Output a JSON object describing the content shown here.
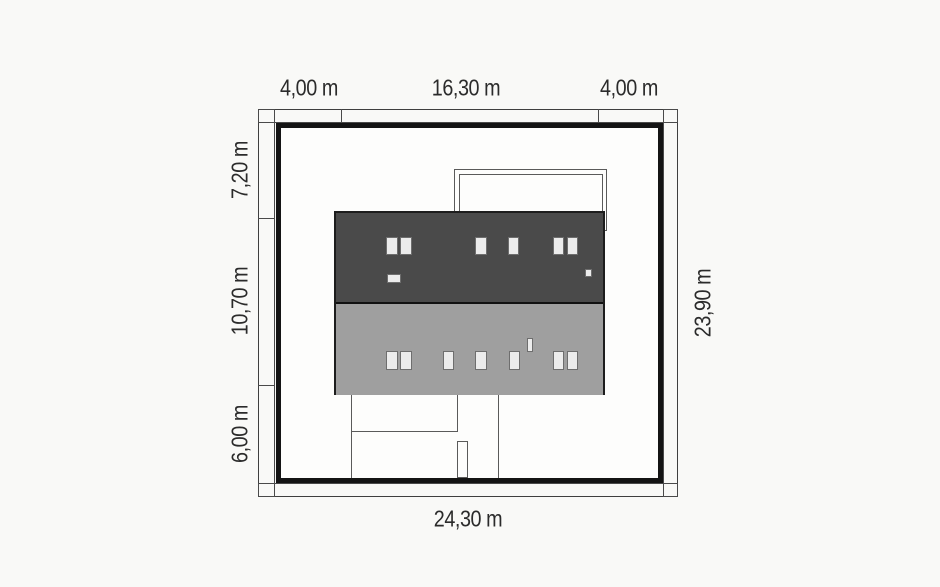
{
  "diagram": {
    "type": "house-plot-site-plan",
    "unit": "m",
    "dims": {
      "top_left": "4,00 m",
      "top_center": "16,30 m",
      "top_right": "4,00 m",
      "left_top": "7,20 m",
      "left_middle": "10,70 m",
      "left_bottom": "6,00 m",
      "right_total": "23,90 m",
      "bottom_total": "24,30 m"
    },
    "colors": {
      "background": "#f9f9f7",
      "plot_boundary": "#141414",
      "dimension_line": "#4a4a4a",
      "roof_dark": "#4a4a4a",
      "roof_light": "#9f9f9f",
      "roof_window_fill": "#ececec",
      "roof_window_border": "#6e6e6e",
      "label_text": "#2b2b2b"
    }
  }
}
